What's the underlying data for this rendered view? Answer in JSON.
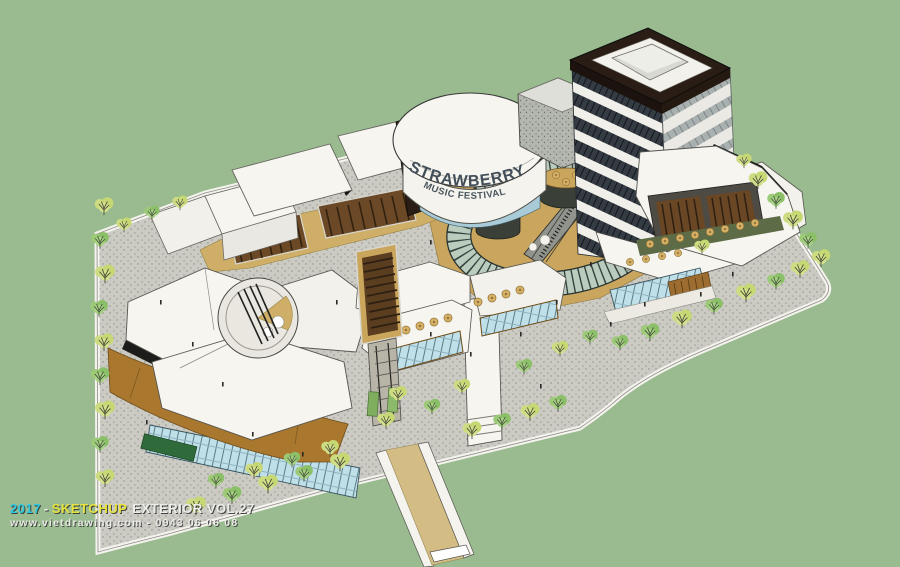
{
  "signage": {
    "drum_line1": "STRAWBERRY",
    "drum_line2": "MUSIC FESTIVAL"
  },
  "watermark": {
    "year": "2017",
    "separator": "-",
    "brand": "SKETCHUP",
    "title": "EXTERIOR VOL.27",
    "line2": "www.vietdrawing.com - 0943 06 06 08",
    "colors": {
      "year": "#2ec9e0",
      "brand": "#e8e43e",
      "text": "#ededea"
    }
  },
  "palette": {
    "background": "#9abb90",
    "paving": "#cbcac3",
    "curb": "#f4f3ee",
    "roof_white": "#f6f5f0",
    "plaza_tan": "#c9a55e",
    "walkway_tan": "#cfae68",
    "wood_brown": "#a9772e",
    "dark_parapet": "#2a1d16",
    "glass_blue": "#bfdfe9",
    "ring_glass": "#b9cfc6",
    "tree_yellow": "#cddc80",
    "tree_green": "#9cca77"
  }
}
